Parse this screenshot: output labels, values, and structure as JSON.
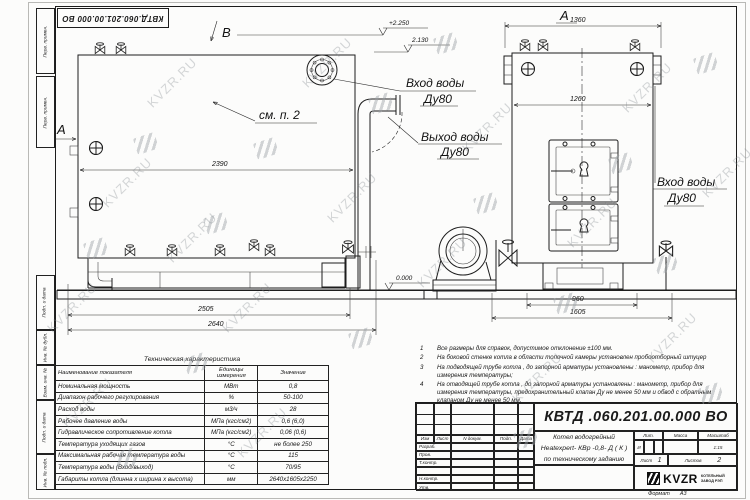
{
  "watermark": {
    "text": "KVZR.RU"
  },
  "stamp": {
    "code": "КВТД.060.201.00.000  ВО"
  },
  "margin": {
    "labels": [
      "Перв. примен.",
      "Перв. примен.",
      "Подп. и дата",
      "Инв. № дубл.",
      "Взам. инв. №",
      "Подп. и дата",
      "Инв. № подл."
    ]
  },
  "front": {
    "marker_a": "A",
    "marker_b": "B",
    "see_note": "см. п. 2",
    "dim_width": "2390",
    "dim_base": "2505",
    "dim_total": "2640",
    "elev_top": "+2.250",
    "elev_mid": "2.130",
    "elev_zero": "0.000",
    "inlet_line1": "Вход воды",
    "inlet_line2": "Ду80",
    "outlet_line1": "Выход воды",
    "outlet_line2": "Ду80"
  },
  "side": {
    "marker": "А",
    "dim_top": "1360",
    "dim_inner": "1260",
    "dim_base": "960",
    "dim_total": "1605",
    "inlet_line1": "Вход воды",
    "inlet_line2": "Ду80"
  },
  "spec": {
    "title": "Техническая характеристика",
    "headers": [
      "Наименование показателя",
      "Единицы измерения",
      "Значение"
    ],
    "rows": [
      [
        "Номинальная мощность",
        "МВт",
        "0,8"
      ],
      [
        "Диапазон рабочего регулирования",
        "%",
        "50-100"
      ],
      [
        "Расход воды",
        "м3/ч",
        "28"
      ],
      [
        "Рабочее давление воды",
        "МПа (кгс/см2)",
        "0,6 (6,0)"
      ],
      [
        "Гидравлическое сопротивление котла",
        "МПа (кгс/см2)",
        "0,06 (0,6)"
      ],
      [
        "Температура уходящих газов",
        "°С",
        "не более 250"
      ],
      [
        "Максимальная рабочая температура воды",
        "°С",
        "115"
      ],
      [
        "Температура воды (Вход/выход)",
        "°С",
        "70/95"
      ],
      [
        "Габариты котла (длинна х ширина х высота)",
        "мм",
        "2640х1605х2250"
      ]
    ]
  },
  "notes": [
    {
      "num": "1",
      "text": "Все размеры для справок, допустимое отклонение ±100 мм."
    },
    {
      "num": "2",
      "text": "На боковой стенке котла в области топочной камеры установлен пробоотборный штуцер"
    },
    {
      "num": "3",
      "text": "На  подводящей трубе котла , до запорной арматуры установлены : манометр, прибор для измерения температуры;"
    },
    {
      "num": "4",
      "text": "На отводящей трубе котла , до запорной арматуры установлены : манометр, прибор для измерения температуры, предохранительный клапан  Ду не менее  50 мм и обвод с обратным клапаном  Ду не менее 50 мм."
    }
  ],
  "title_block": {
    "doc_number": "КВТД .060.201.00.000  ВО",
    "header_cells": [
      "Изм",
      "Лист",
      "N докум.",
      "Подп.",
      "Дата"
    ],
    "row_labels": [
      "Разраб.",
      "Пров.",
      "Т.контр.",
      "Н.контр.",
      "Утв."
    ],
    "name_line1": "Котел водогрейный",
    "name_line2": "Heatexpert- КВр -0,8- Д ( К )",
    "name_line3": "по техническому заданию",
    "lit_label": "Лит.",
    "mass_label": "Масса",
    "scale_label": "Масштаб",
    "lit_value": "И",
    "scale_value": "1:15",
    "sheet_label": "Лист",
    "sheet_value": "1",
    "sheets_label": "Листов",
    "sheets_value": "2",
    "logo_text": "KVZR",
    "logo_sub1": "КОТЕЛЬНЫЙ",
    "logo_sub2": "ЗАВОД РЭП",
    "format_label": "Формат",
    "format_value": "А3"
  }
}
